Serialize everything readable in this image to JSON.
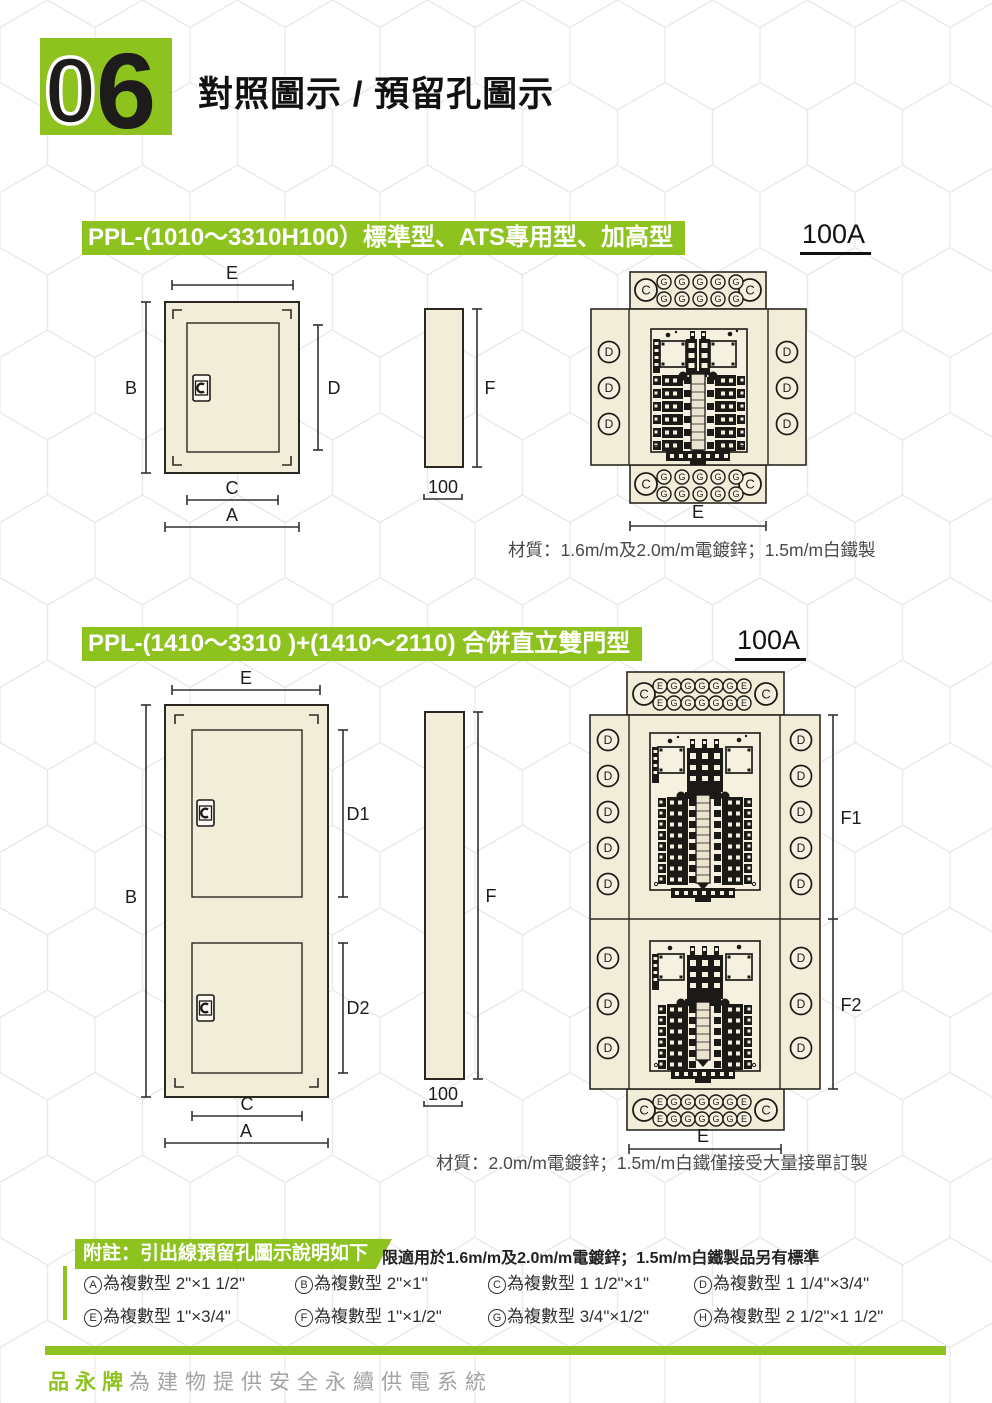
{
  "page": {
    "badge_zero": "0",
    "badge_six": "6",
    "title": "對照圖示 / 預留孔圖示"
  },
  "labels": {
    "A": "A",
    "B": "B",
    "C": "C",
    "D": "D",
    "E": "E",
    "F": "F",
    "G": "G",
    "D1": "D1",
    "D2": "D2",
    "F1": "F1",
    "F2": "F2",
    "depth": "100"
  },
  "section1": {
    "title": "PPL-(1010～3310H100）標準型、ATS專用型、加高型",
    "rating": "100A",
    "material": "材質：1.6m/m及2.0m/m電鍍鋅；1.5m/m白鐵製"
  },
  "section2": {
    "title": "PPL-(1410～3310 )+(1410～2110) 合併直立雙門型",
    "rating": "100A",
    "material": "材質：2.0m/m電鍍鋅；1.5m/m白鐵僅接受大量接單訂製"
  },
  "notes": {
    "tag": "附註：引出線預留孔圖示說明如下",
    "restriction": "限適用於1.6m/m及2.0m/m電鍍鋅；1.5m/m白鐵製品另有標準",
    "legend": [
      {
        "key": "A",
        "desc": "為複數型 2\"×1 1/2\""
      },
      {
        "key": "B",
        "desc": "為複數型 2\"×1\""
      },
      {
        "key": "C",
        "desc": "為複數型 1 1/2\"×1\""
      },
      {
        "key": "D",
        "desc": "為複數型 1 1/4\"×3/4\""
      },
      {
        "key": "E",
        "desc": "為複數型 1\"×3/4\""
      },
      {
        "key": "F",
        "desc": "為複數型 1\"×1/2\""
      },
      {
        "key": "G",
        "desc": "為複數型 3/4\"×1/2\""
      },
      {
        "key": "H",
        "desc": "為複數型 2 1/2\"×1 1/2\""
      }
    ]
  },
  "footer": {
    "brand": "品永牌",
    "tagline": "為建物提供安全永續供電系統"
  },
  "colors": {
    "green": "#8dc21f",
    "panel": "#f2edd9",
    "line": "#1c1a16"
  }
}
